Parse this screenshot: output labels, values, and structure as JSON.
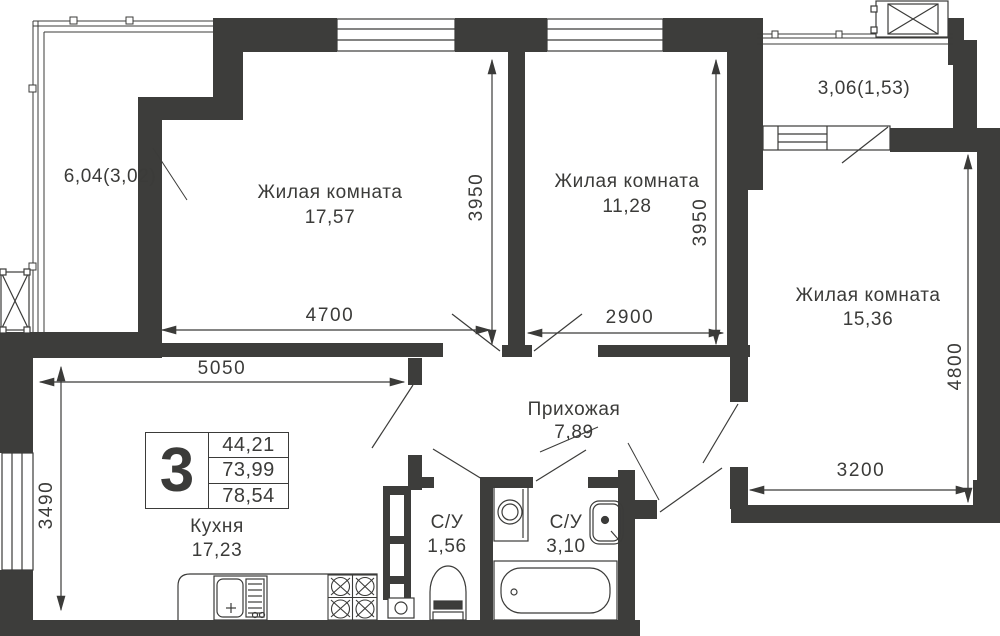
{
  "colors": {
    "wall": "#3d3d3b",
    "line": "#3b3b39",
    "background": "#ffffff"
  },
  "rooms": {
    "room1": {
      "name": "Жилая комната",
      "area": "17,57"
    },
    "room2": {
      "name": "Жилая комната",
      "area": "11,28"
    },
    "room3": {
      "name": "Жилая комната",
      "area": "15,36"
    },
    "hallway": {
      "name": "Прихожая",
      "area": "7,89"
    },
    "kitchen": {
      "name": "Кухня",
      "area": "17,23"
    },
    "wc_small": {
      "name": "С/У",
      "area": "1,56"
    },
    "wc_big": {
      "name": "С/У",
      "area": "3,10"
    }
  },
  "balconies": {
    "left": {
      "label": "6,04(3,02)"
    },
    "right": {
      "label": "3,06(1,53)"
    }
  },
  "dimensions": {
    "room1_width": "4700",
    "room1_height": "3950",
    "room2_width": "2900",
    "room2_height": "3950",
    "room3_width": "3200",
    "room3_height": "4800",
    "kitchen_width": "5050",
    "kitchen_height": "3490"
  },
  "info_box": {
    "rooms_count": "3",
    "areas": [
      "44,21",
      "73,99",
      "78,54"
    ]
  }
}
